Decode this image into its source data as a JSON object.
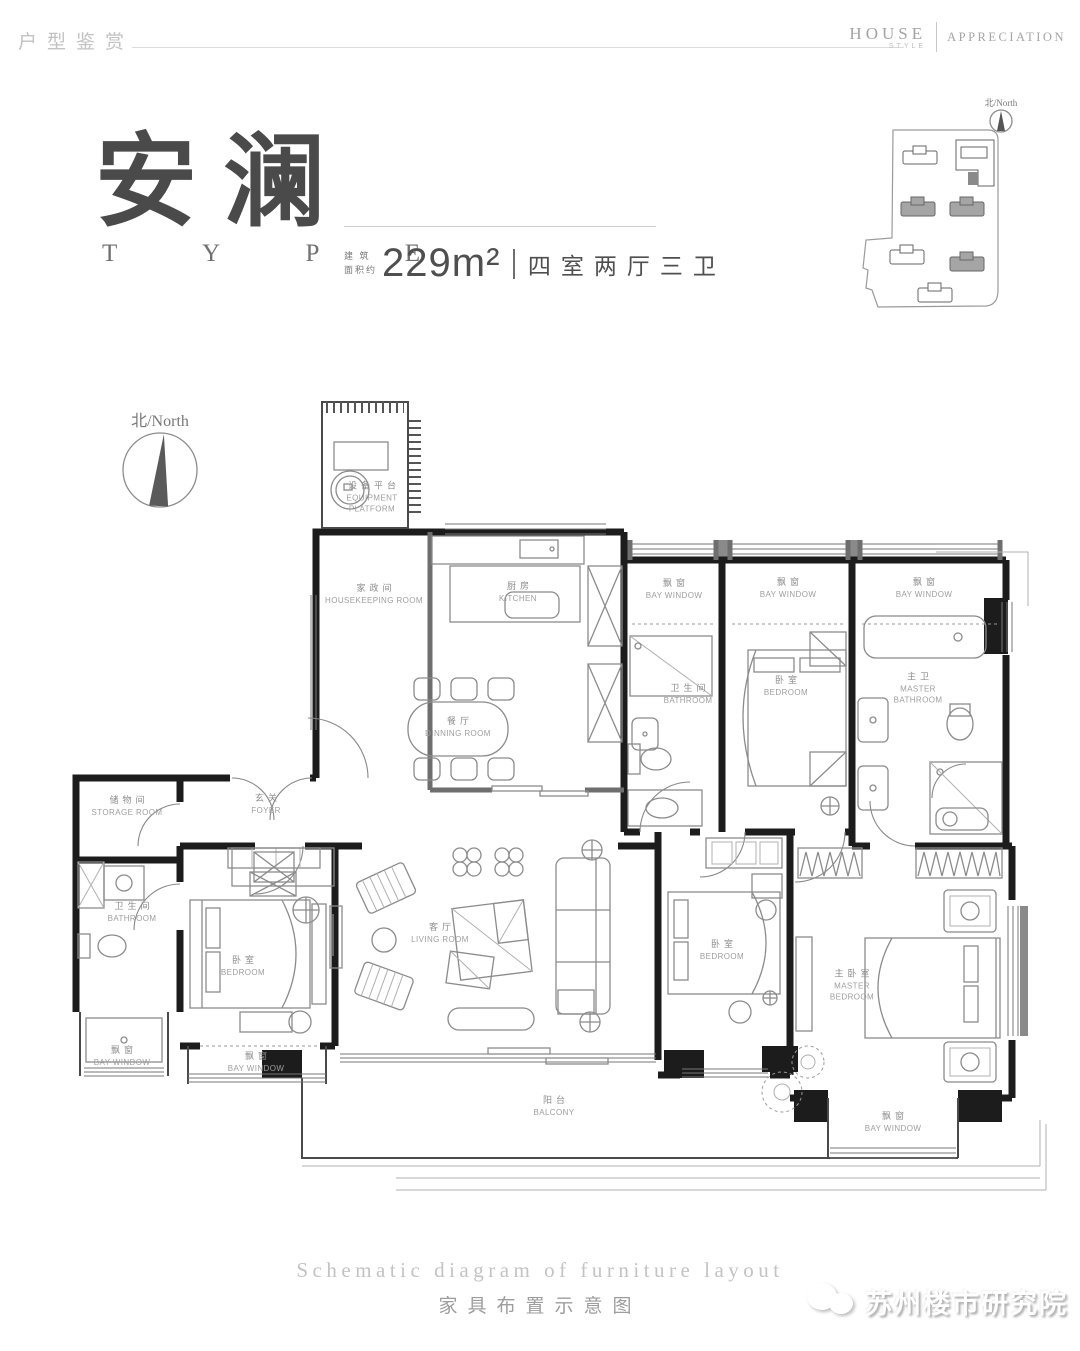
{
  "header": {
    "section_title_zh": "户型鉴赏",
    "brand_primary": "HOUSE",
    "brand_secondary": "STYLE",
    "brand_right": "APPRECIATION"
  },
  "hero": {
    "title_zh": "安澜",
    "title_en": "T Y P E",
    "area_prefix_line1": "建 筑",
    "area_prefix_line2": "面积约",
    "area_value": "229m²",
    "spec": "四室两厅三卫"
  },
  "site_plan": {
    "compass_label": "北/North"
  },
  "main_compass": {
    "label": "北/North"
  },
  "plan": {
    "rooms": [
      {
        "zh": "设备平台",
        "en": "EQUIPMENT PLATFORM",
        "x": 372,
        "y": 497,
        "w": 88
      },
      {
        "zh": "家政间",
        "en": "HOUSEKEEPING ROOM",
        "x": 374,
        "y": 594,
        "w": 100
      },
      {
        "zh": "厨房",
        "en": "KITCHEN",
        "x": 518,
        "y": 592
      },
      {
        "zh": "飘窗",
        "en": "BAY WINDOW",
        "x": 674,
        "y": 589,
        "w": 82
      },
      {
        "zh": "飘窗",
        "en": "BAY WINDOW",
        "x": 788,
        "y": 588,
        "w": 82
      },
      {
        "zh": "飘窗",
        "en": "BAY WINDOW",
        "x": 924,
        "y": 588,
        "w": 82
      },
      {
        "zh": "卫生间",
        "en": "BATHROOM",
        "x": 688,
        "y": 694
      },
      {
        "zh": "卧室",
        "en": "BEDROOM",
        "x": 786,
        "y": 686
      },
      {
        "zh": "主卫",
        "en": "MASTER BATHROOM",
        "x": 918,
        "y": 688,
        "w": 72
      },
      {
        "zh": "餐厅",
        "en": "DINNING ROOM",
        "x": 458,
        "y": 727
      },
      {
        "zh": "储物间",
        "en": "STORAGE ROOM",
        "x": 127,
        "y": 806
      },
      {
        "zh": "玄关",
        "en": "FOYER",
        "x": 266,
        "y": 804
      },
      {
        "zh": "卫生间",
        "en": "BATHROOM",
        "x": 132,
        "y": 912
      },
      {
        "zh": "卧室",
        "en": "BEDROOM",
        "x": 243,
        "y": 966
      },
      {
        "zh": "客厅",
        "en": "LIVING ROOM",
        "x": 440,
        "y": 933
      },
      {
        "zh": "卧室",
        "en": "BEDROOM",
        "x": 722,
        "y": 950
      },
      {
        "zh": "主卧室",
        "en": "MASTER BEDROOM",
        "x": 852,
        "y": 985,
        "w": 82
      },
      {
        "zh": "飘窗",
        "en": "BAY WINDOW",
        "x": 122,
        "y": 1056,
        "w": 78
      },
      {
        "zh": "飘窗",
        "en": "BAY WINDOW",
        "x": 256,
        "y": 1062,
        "w": 82
      },
      {
        "zh": "阳台",
        "en": "BALCONY",
        "x": 554,
        "y": 1106
      },
      {
        "zh": "飘窗",
        "en": "BAY WINDOW",
        "x": 893,
        "y": 1122,
        "w": 82
      }
    ]
  },
  "footer": {
    "caption_en": "Schematic diagram of furniture layout",
    "caption_zh": "家具布置示意图"
  },
  "watermark": {
    "name": "苏州楼市研究院"
  }
}
